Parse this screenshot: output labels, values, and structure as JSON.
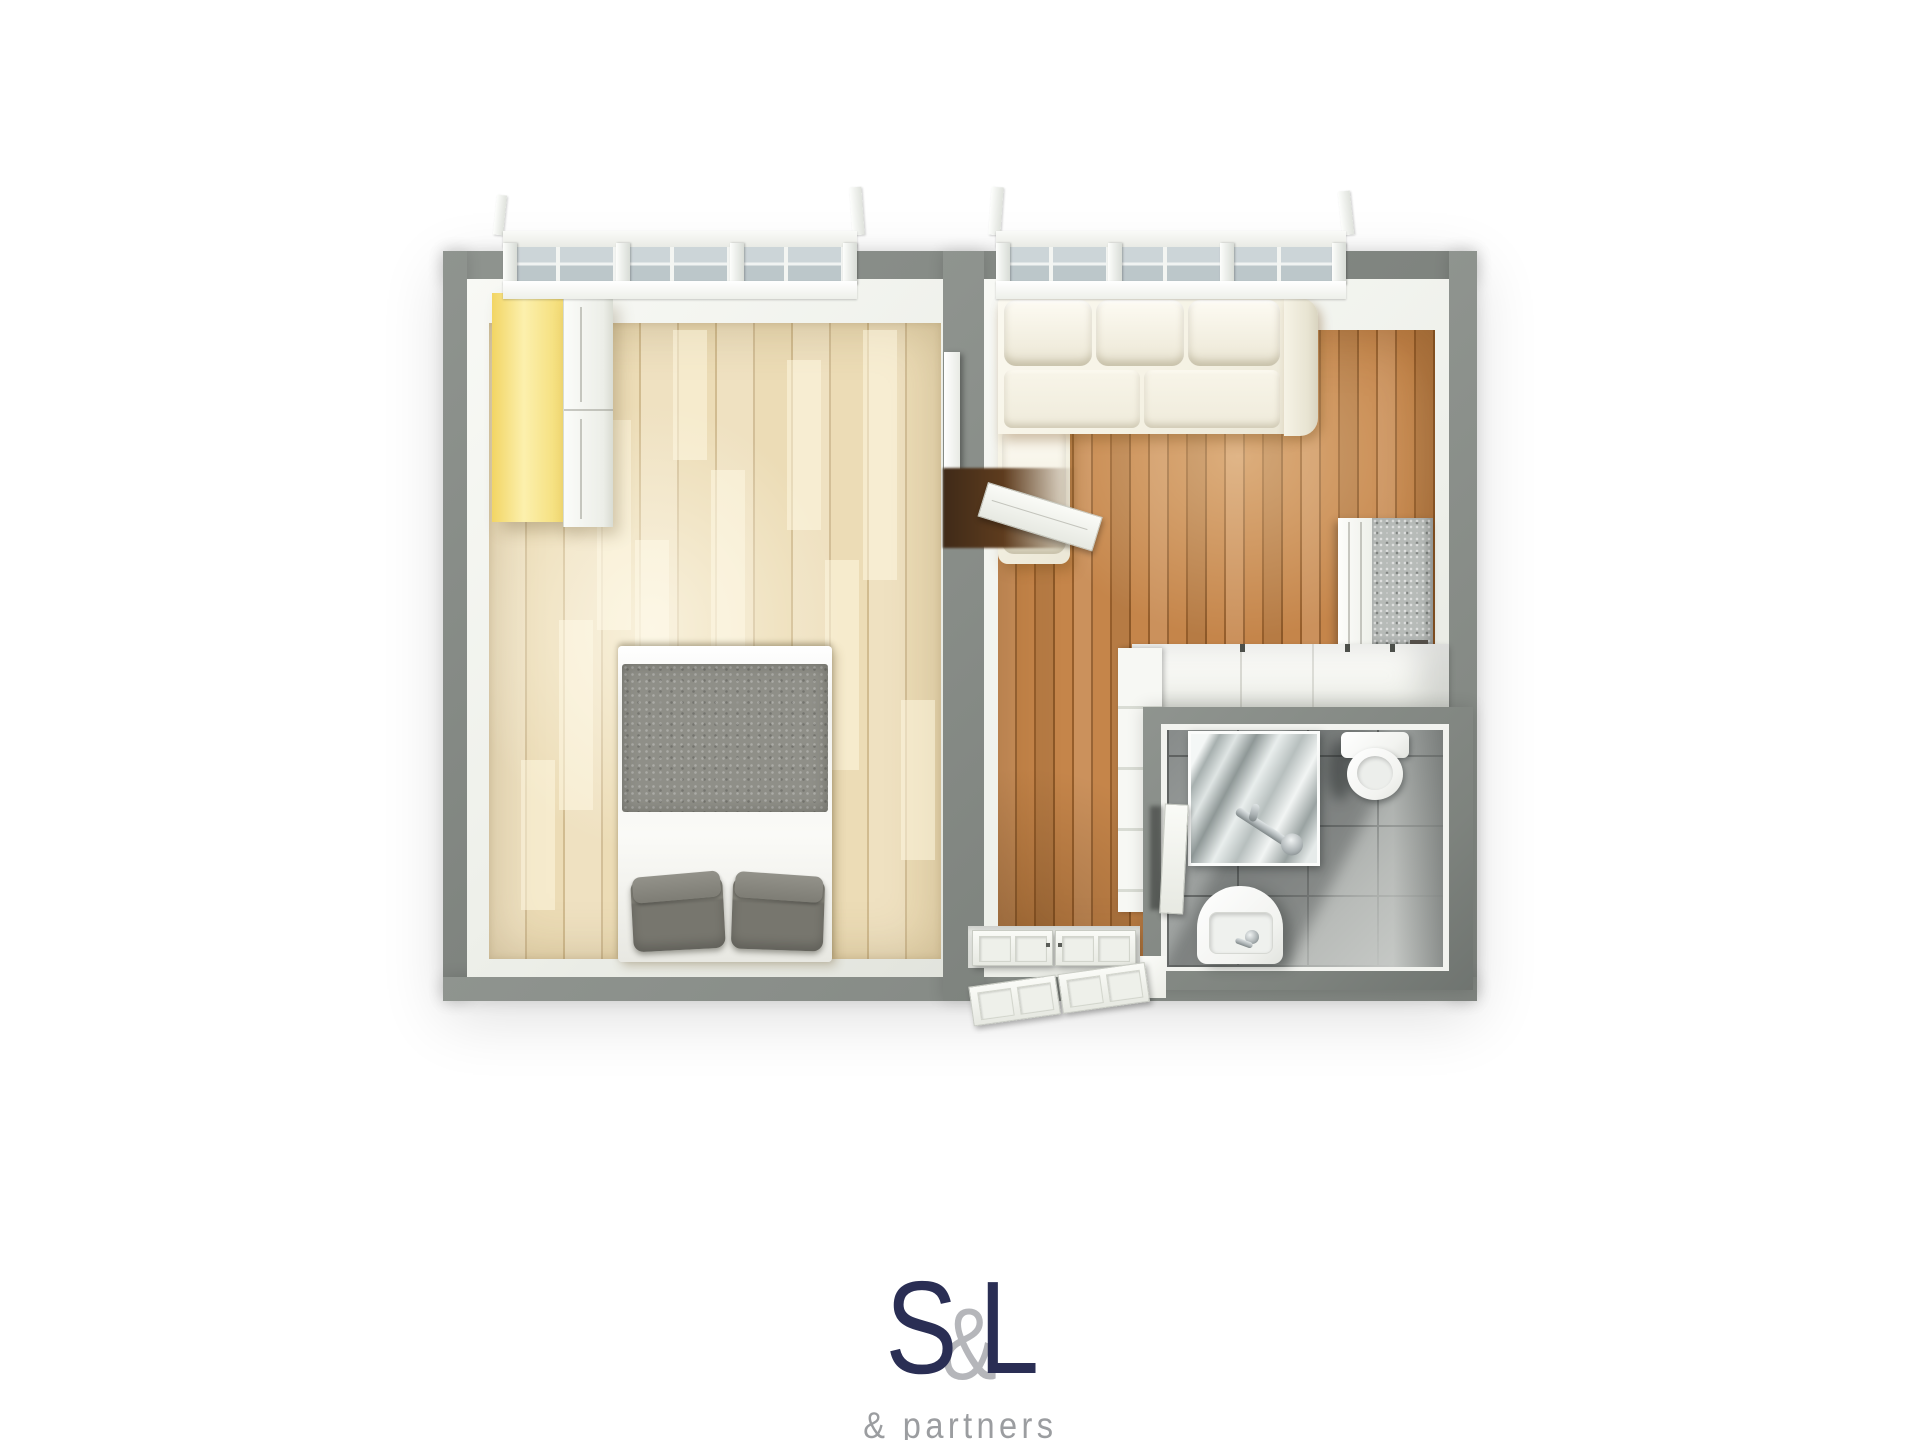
{
  "logo": {
    "letter_s": "S",
    "ampersand": "&",
    "letter_l": "L",
    "tagline": "& partners"
  },
  "palette": {
    "wall": "#8f948f",
    "wallDark": "#7e837e",
    "innerWall": "#eef0ea",
    "innerBright": "#f8f9f5",
    "bedFloor": "#ecdcb6",
    "lrFloor": "#c5854a",
    "sofa": "#f5f2e4",
    "duvet": "#8f8f88",
    "pillow": "#77766e",
    "bedWhite": "#fafaf7",
    "yellow": "#f4dc74",
    "glass": "#ccd5d8",
    "tileBase": "#b9bcb9",
    "grout": "#3c3f3e",
    "chrome": "#aab1b3",
    "darkWood": "#5e3c1e",
    "entry": "#e6e8e3",
    "navy": "#2a2e54",
    "logoAmp": "#b5b6ba",
    "tagline": "#9b9da0"
  },
  "scene": {
    "rooms": [
      "bedroom",
      "living-room",
      "bathroom",
      "entry"
    ],
    "bedroom_items": [
      "wardrobe",
      "double-bed",
      "window"
    ],
    "living_items": [
      "corner-sofa",
      "tv-panel",
      "interior-door",
      "appliance",
      "kitchen-counter",
      "window"
    ],
    "bathroom_items": [
      "shower",
      "toilet",
      "sink",
      "vanity-column",
      "bathroom-door"
    ],
    "entry_items": [
      "double-entry-doors"
    ]
  }
}
